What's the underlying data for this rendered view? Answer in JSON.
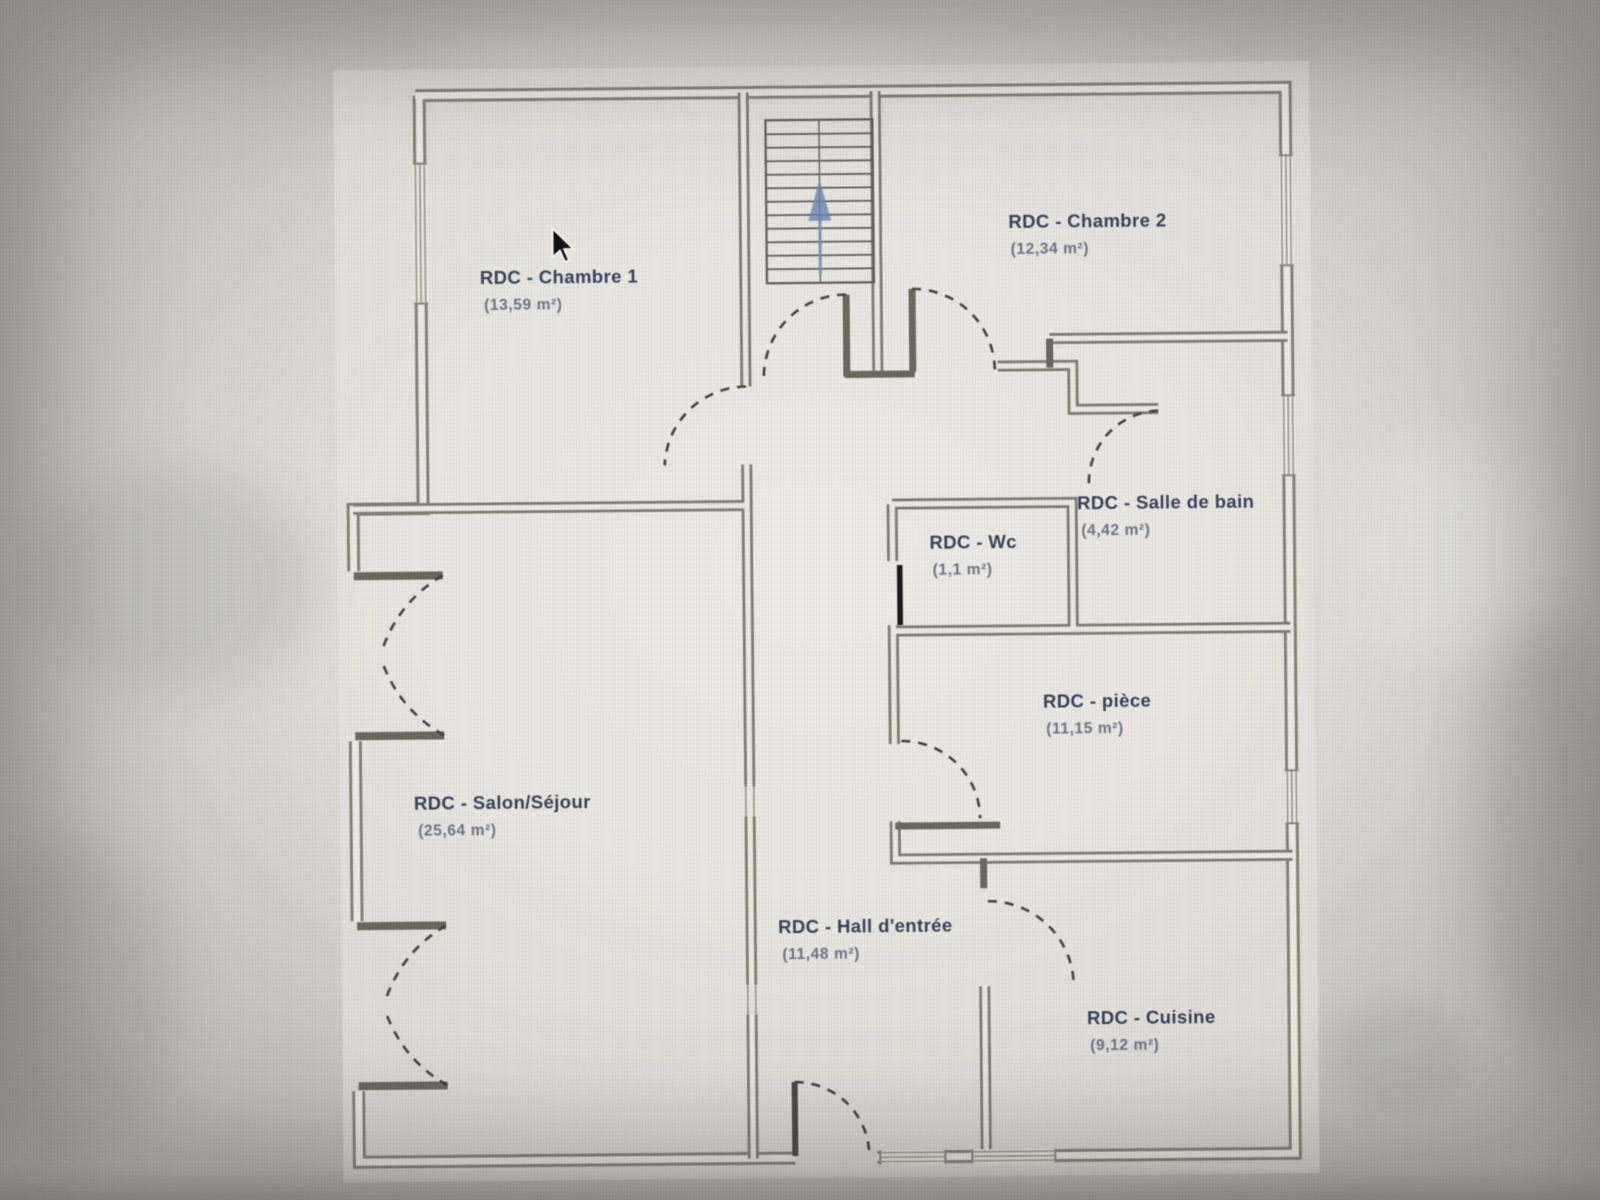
{
  "plan": {
    "floor": "RDC",
    "rooms": [
      {
        "name": "RDC - Chambre 1",
        "area": "(13,59 m²)"
      },
      {
        "name": "RDC - Chambre 2",
        "area": "(12,34 m²)"
      },
      {
        "name": "RDC - Salle de bain",
        "area": "(4,42 m²)"
      },
      {
        "name": "RDC - Wc",
        "area": "(1,1 m²)"
      },
      {
        "name": "RDC - pièce",
        "area": "(11,15 m²)"
      },
      {
        "name": "RDC - Salon/Séjour",
        "area": "(25,64 m²)"
      },
      {
        "name": "RDC - Hall d'entrée",
        "area": "(11,48 m²)"
      },
      {
        "name": "RDC - Cuisine",
        "area": "(9,12 m²)"
      }
    ]
  },
  "colors": {
    "background": "#d2d1cc",
    "plan_background": "#e9e8e3",
    "wall": "#7e7b75",
    "wall_dark": "#6a675f",
    "door_arc": "#44423d",
    "label_text": "#3a4156",
    "area_text": "#515870",
    "stairs_arrow_blue": "#6884b2",
    "door_leaf_black": "#191919"
  },
  "icons": {
    "mouse_cursor": "arrow-pointer",
    "stairs_direction": "up-arrow"
  }
}
